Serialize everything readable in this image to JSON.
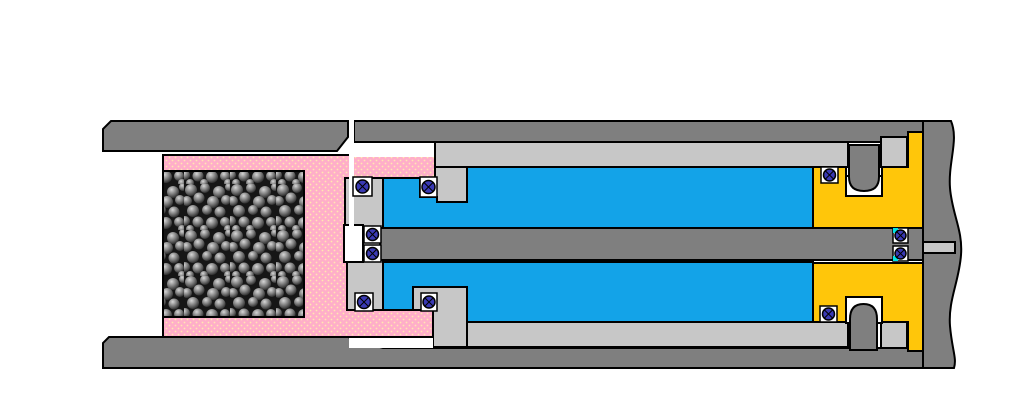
{
  "meta": {
    "description": "Cross-section engineering diagram of a hydropneumatic recoil damper: outer tube, pink chamber filled with steel balls, silver inner cylinder, blue hydraulic fluid chambers, central piston rod, yellow end gland blocks, and O-ring seals",
    "canvas": {
      "width": 1024,
      "height": 414
    }
  },
  "palette": {
    "background": "#FFFFFF",
    "outer_gray": "#7F7F7F",
    "steel_gray": "#C7C7C7",
    "pink": "#FFAEC9",
    "pink_dot": "#FFE9B0",
    "fluid_blue": "#13A3E8",
    "gland_yellow": "#FFC60A",
    "seal_navy": "#3A3AB4",
    "seal_cyan": "#00E5E5",
    "ball_background": "#161616",
    "outline": "#000000",
    "white": "#FFFFFF"
  },
  "components": {
    "outer_tube_top": "outer tube upper wall",
    "outer_tube_bottom": "outer tube lower wall",
    "ball_chamber": "chamber filled with steel balls",
    "pink_chamber": "pink pressure chamber",
    "inner_cylinder": "silver inner cylinder body",
    "fluid_upper": "upper hydraulic fluid chamber",
    "fluid_lower": "lower hydraulic fluid chamber",
    "piston_rod": "central piston rod",
    "end_gland": "yellow end gland block",
    "end_wall": "right end wall with break line",
    "seals": "O-ring seals (12)"
  }
}
